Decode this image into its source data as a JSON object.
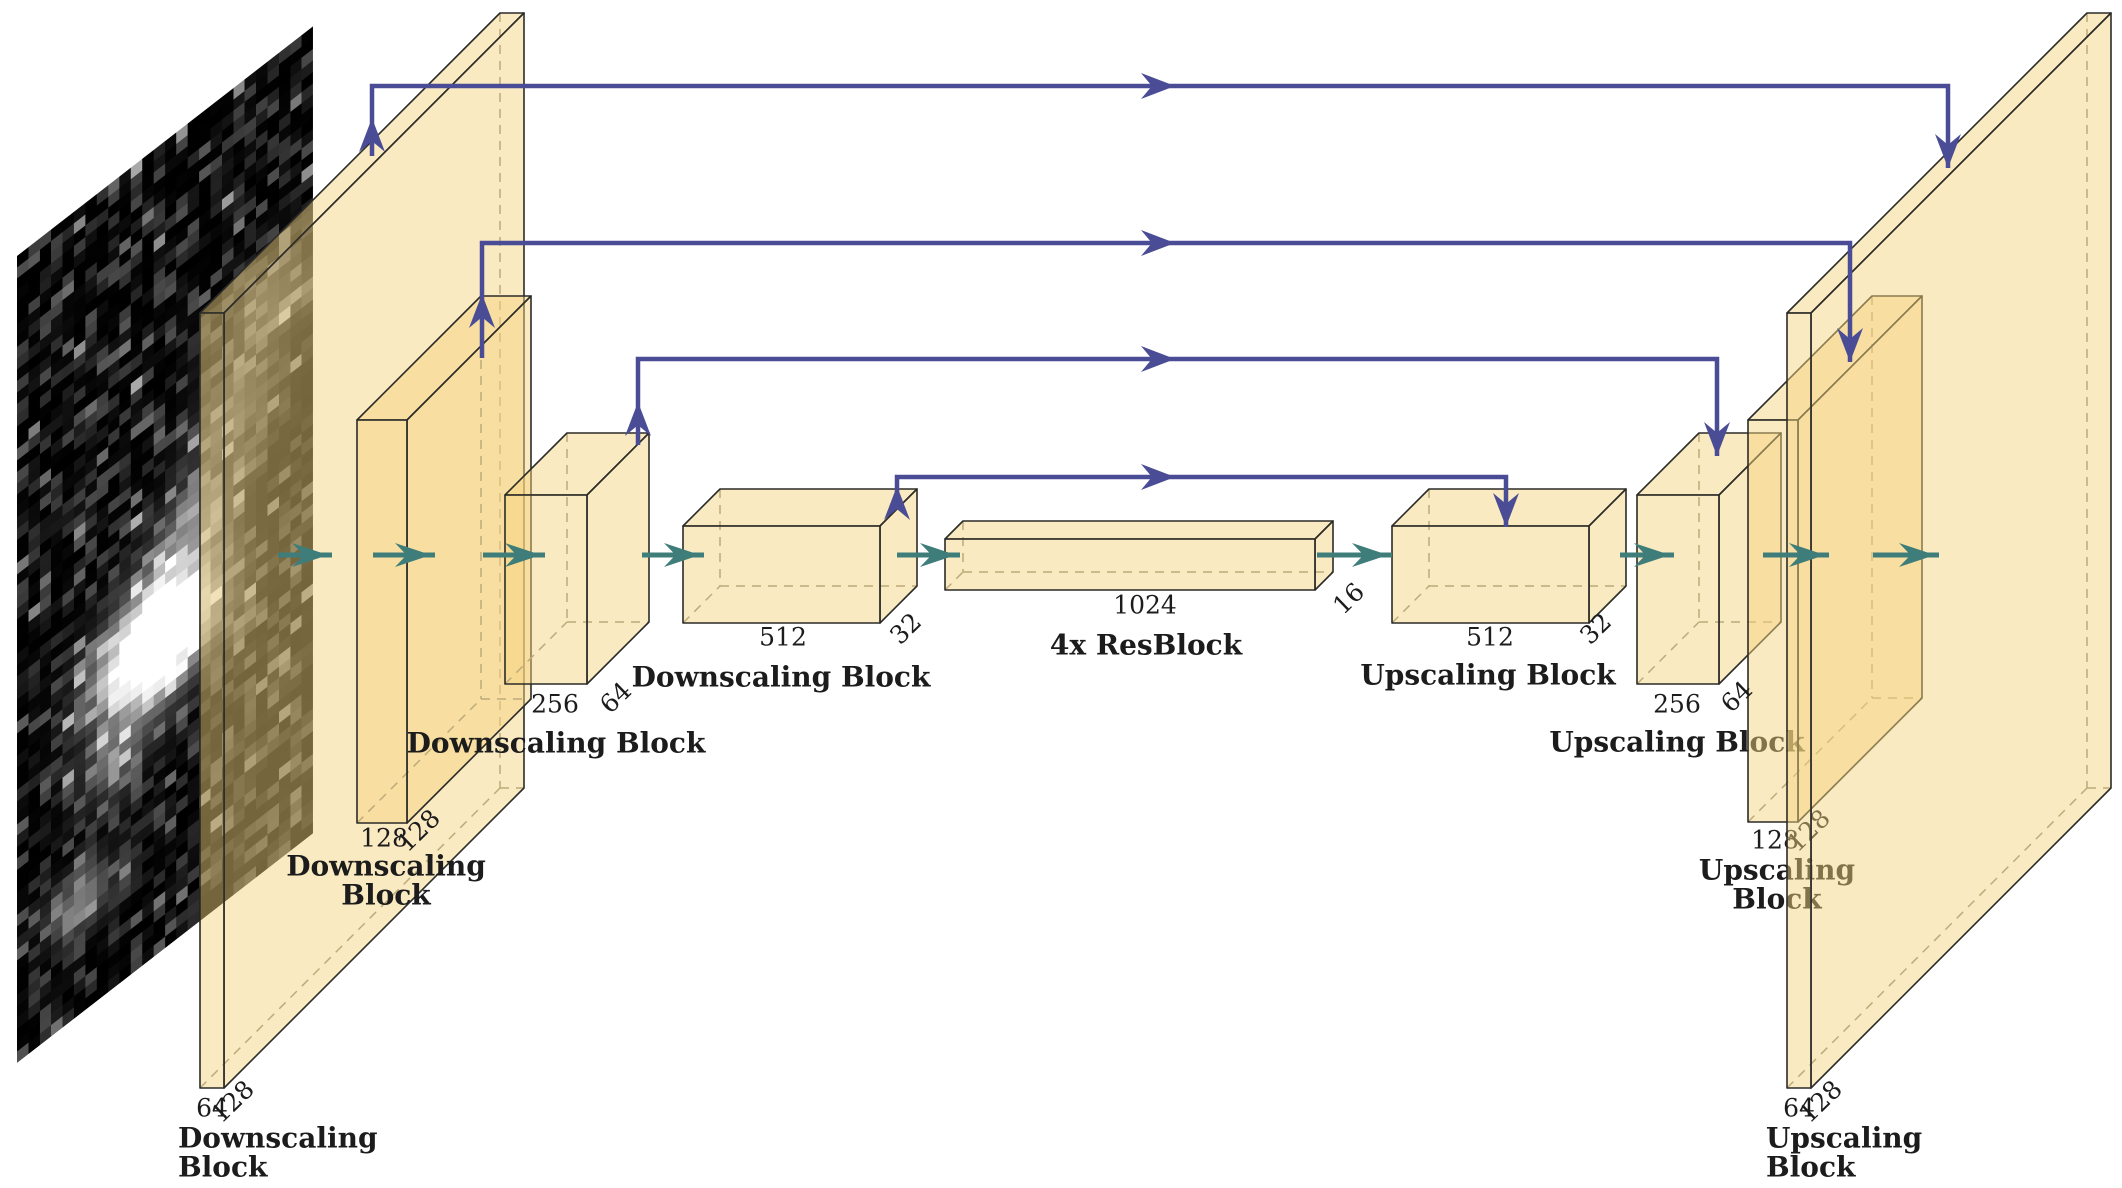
{
  "figure": {
    "width": 2122,
    "height": 1188,
    "background": "#ffffff",
    "description": "U-Net architecture diagram with galaxy image input"
  },
  "colors": {
    "box_fill": "rgba(245,211,125,0.48)",
    "edge": "#2b2b28",
    "hidden_edge": "#8a8779",
    "skip_arrow": "#4a4d96",
    "flow_arrow": "#3f7d7a"
  },
  "galaxy": {
    "x": 17,
    "y": 256,
    "w": 296,
    "h": 807,
    "skew_deg": -37.8,
    "cols": 26,
    "rows": 71,
    "seed": 13,
    "blobs": [
      {
        "cx": 0.48,
        "cy": 0.61,
        "r": 0.13,
        "i": 1.7
      },
      {
        "cx": 0.6,
        "cy": 0.5,
        "r": 0.1,
        "i": 0.45
      },
      {
        "cx": 0.72,
        "cy": 0.4,
        "r": 0.1,
        "i": 0.35
      },
      {
        "cx": 0.85,
        "cy": 0.3,
        "r": 0.1,
        "i": 0.3
      },
      {
        "cx": 0.33,
        "cy": 0.72,
        "r": 0.08,
        "i": 0.35
      },
      {
        "cx": 0.22,
        "cy": 0.86,
        "r": 0.07,
        "i": 0.5
      }
    ]
  },
  "blocks": [
    {
      "name": "downscale-block-1-output",
      "front": [
        200,
        313,
        24,
        775
      ],
      "depth": [
        300,
        -300
      ]
    },
    {
      "name": "downscale-block-2-output",
      "front": [
        357,
        420,
        50,
        403
      ],
      "depth": [
        124,
        -124
      ]
    },
    {
      "name": "downscale-block-3-output",
      "front": [
        505,
        495,
        82,
        189
      ],
      "depth": [
        62,
        -62
      ]
    },
    {
      "name": "downscale-block-4-output",
      "front": [
        683,
        526,
        197,
        97
      ],
      "depth": [
        37,
        -37
      ]
    },
    {
      "name": "bottleneck-output",
      "front": [
        945,
        539,
        370,
        51
      ],
      "depth": [
        18,
        -18
      ]
    },
    {
      "name": "upscale-block-1-output",
      "front": [
        1392,
        526,
        197,
        97
      ],
      "depth": [
        37,
        -37
      ]
    },
    {
      "name": "upscale-block-2-output",
      "front": [
        1637,
        495,
        82,
        189
      ],
      "depth": [
        62,
        -62
      ]
    },
    {
      "name": "upscale-block-3-output",
      "front": [
        1748,
        420,
        50,
        402
      ],
      "depth": [
        124,
        -124
      ],
      "layer_break_before": "behindH"
    },
    {
      "name": "upscale-block-4-output",
      "front": [
        1787,
        313,
        24,
        775
      ],
      "depth": [
        300,
        -300
      ],
      "layer_break_before": "behindI"
    }
  ],
  "labels": [
    {
      "text": "64",
      "x": 212,
      "y": 1110,
      "size": 25,
      "bold": false,
      "anchor": "middle",
      "rot": 0,
      "layer": "front"
    },
    {
      "text": "128",
      "x": 234,
      "y": 1103,
      "size": 25,
      "bold": false,
      "anchor": "middle",
      "rot": -44,
      "layer": "front"
    },
    {
      "text": "Downscaling",
      "x": 178,
      "y": 1140,
      "size": 28,
      "bold": true,
      "anchor": "start",
      "rot": 0,
      "layer": "front"
    },
    {
      "text": "Block",
      "x": 178,
      "y": 1169,
      "size": 28,
      "bold": true,
      "anchor": "start",
      "rot": 0,
      "layer": "front"
    },
    {
      "text": "128",
      "x": 384,
      "y": 840,
      "size": 25,
      "bold": false,
      "anchor": "middle",
      "rot": 0,
      "layer": "front"
    },
    {
      "text": "128",
      "x": 420,
      "y": 832,
      "size": 25,
      "bold": false,
      "anchor": "middle",
      "rot": -44,
      "layer": "front"
    },
    {
      "text": "Downscaling",
      "x": 386,
      "y": 868,
      "size": 28,
      "bold": true,
      "anchor": "middle",
      "rot": 0,
      "layer": "front"
    },
    {
      "text": "Block",
      "x": 386,
      "y": 897,
      "size": 28,
      "bold": true,
      "anchor": "middle",
      "rot": 0,
      "layer": "front"
    },
    {
      "text": "256",
      "x": 555,
      "y": 706,
      "size": 25,
      "bold": false,
      "anchor": "middle",
      "rot": 0,
      "layer": "front"
    },
    {
      "text": "64",
      "x": 617,
      "y": 699,
      "size": 25,
      "bold": false,
      "anchor": "middle",
      "rot": -44,
      "layer": "front"
    },
    {
      "text": "Downscaling Block",
      "x": 556,
      "y": 745,
      "size": 28,
      "bold": true,
      "anchor": "middle",
      "rot": 0,
      "layer": "front"
    },
    {
      "text": "512",
      "x": 783,
      "y": 639,
      "size": 25,
      "bold": false,
      "anchor": "middle",
      "rot": 0,
      "layer": "front"
    },
    {
      "text": "32",
      "x": 907,
      "y": 630,
      "size": 25,
      "bold": false,
      "anchor": "middle",
      "rot": -44,
      "layer": "front"
    },
    {
      "text": "Downscaling Block",
      "x": 781,
      "y": 679,
      "size": 28,
      "bold": true,
      "anchor": "middle",
      "rot": 0,
      "layer": "front"
    },
    {
      "text": "1024",
      "x": 1145,
      "y": 607,
      "size": 25,
      "bold": false,
      "anchor": "middle",
      "rot": 0,
      "layer": "front"
    },
    {
      "text": "16",
      "x": 1350,
      "y": 600,
      "size": 25,
      "bold": false,
      "anchor": "middle",
      "rot": -44,
      "layer": "front"
    },
    {
      "text": "4x ResBlock",
      "x": 1146,
      "y": 647,
      "size": 28,
      "bold": true,
      "anchor": "middle",
      "rot": 0,
      "layer": "front"
    },
    {
      "text": "512",
      "x": 1490,
      "y": 639,
      "size": 25,
      "bold": false,
      "anchor": "middle",
      "rot": 0,
      "layer": "front"
    },
    {
      "text": "32",
      "x": 1597,
      "y": 630,
      "size": 25,
      "bold": false,
      "anchor": "middle",
      "rot": -44,
      "layer": "front"
    },
    {
      "text": "Upscaling Block",
      "x": 1488,
      "y": 677,
      "size": 28,
      "bold": true,
      "anchor": "middle",
      "rot": 0,
      "layer": "front"
    },
    {
      "text": "256",
      "x": 1677,
      "y": 706,
      "size": 25,
      "bold": false,
      "anchor": "middle",
      "rot": 0,
      "layer": "front"
    },
    {
      "text": "64",
      "x": 1738,
      "y": 698,
      "size": 25,
      "bold": false,
      "anchor": "middle",
      "rot": -44,
      "layer": "front"
    },
    {
      "text": "Upscaling Block",
      "x": 1677,
      "y": 744,
      "size": 28,
      "bold": true,
      "anchor": "middle",
      "rot": 0,
      "layer": "behindH"
    },
    {
      "text": "128",
      "x": 1775,
      "y": 842,
      "size": 25,
      "bold": false,
      "anchor": "middle",
      "rot": 0,
      "layer": "behindI"
    },
    {
      "text": "128",
      "x": 1810,
      "y": 832,
      "size": 25,
      "bold": false,
      "anchor": "middle",
      "rot": -44,
      "layer": "behindI"
    },
    {
      "text": "Upscaling",
      "x": 1777,
      "y": 872,
      "size": 28,
      "bold": true,
      "anchor": "middle",
      "rot": 0,
      "layer": "behindI"
    },
    {
      "text": "Block",
      "x": 1777,
      "y": 901,
      "size": 28,
      "bold": true,
      "anchor": "middle",
      "rot": 0,
      "layer": "behindI"
    },
    {
      "text": "64",
      "x": 1799,
      "y": 1110,
      "size": 25,
      "bold": false,
      "anchor": "middle",
      "rot": 0,
      "layer": "front"
    },
    {
      "text": "128",
      "x": 1822,
      "y": 1103,
      "size": 25,
      "bold": false,
      "anchor": "middle",
      "rot": -44,
      "layer": "front"
    },
    {
      "text": "Upscaling",
      "x": 1766,
      "y": 1140,
      "size": 28,
      "bold": true,
      "anchor": "start",
      "rot": 0,
      "layer": "front"
    },
    {
      "text": "Block",
      "x": 1766,
      "y": 1169,
      "size": 28,
      "bold": true,
      "anchor": "start",
      "rot": 0,
      "layer": "front"
    }
  ],
  "skip_connections": [
    {
      "name": "skip-connection-1",
      "sx": 372,
      "sy": 156,
      "cy": 86,
      "up_tip": 118,
      "mid_tip_x": 1175,
      "ex": 1948,
      "ey": 168
    },
    {
      "name": "skip-connection-2",
      "sx": 482,
      "sy": 358,
      "cy": 243,
      "up_tip": 294,
      "mid_tip_x": 1175,
      "ex": 1850,
      "ey": 362
    },
    {
      "name": "skip-connection-3",
      "sx": 638,
      "sy": 445,
      "cy": 359,
      "up_tip": 402,
      "mid_tip_x": 1175,
      "ex": 1717,
      "ey": 456
    },
    {
      "name": "skip-connection-4",
      "sx": 897,
      "sy": 508,
      "cy": 477,
      "up_tip": 486,
      "mid_tip_x": 1175,
      "ex": 1506,
      "ey": 527
    }
  ],
  "flow_arrows": {
    "y": 555,
    "spans": [
      [
        278,
        332
      ],
      [
        373,
        435
      ],
      [
        483,
        545
      ],
      [
        642,
        704
      ],
      [
        897,
        960
      ],
      [
        1317,
        1392
      ],
      [
        1620,
        1674
      ],
      [
        1763,
        1829
      ],
      [
        1873,
        1939
      ]
    ]
  }
}
